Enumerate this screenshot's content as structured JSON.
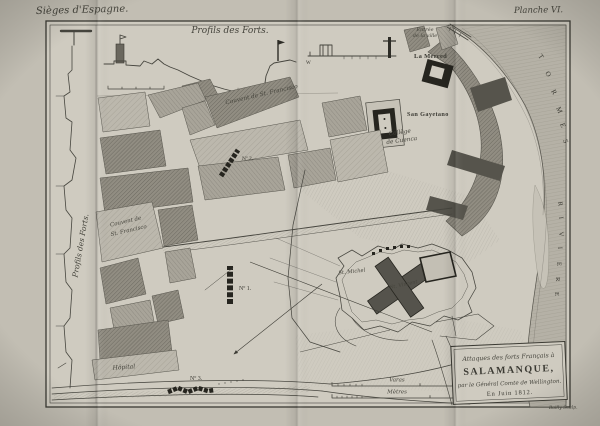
{
  "page": {
    "series_title": "Sièges d'Espagne.",
    "plate_label": "Planche VI.",
    "engraver_credit": "Bailly Sculp."
  },
  "profiles": {
    "title": "Profils des Forts.",
    "ref_letter_w": "W"
  },
  "map": {
    "labels": {
      "entree_line1": "Entrée",
      "entree_line2": "de la ville",
      "la_merced": "La Merced",
      "san_cayetano": "San Gayetano",
      "street_couvent": "Couvent de St. Francisco",
      "college_line1": "Collège",
      "college_line2": "de Cuenca",
      "couvent_line1": "Couvent de",
      "couvent_line2": "St. Francisco",
      "st_michel": "St. Michel",
      "st_vincent": "St. Vincent",
      "hopital": "Hôpital",
      "battery_1": "Nº 1.",
      "battery_2": "Nº 2.",
      "battery_3": "Nº 3."
    },
    "river": {
      "tormes": [
        "T",
        "O",
        "R",
        "M",
        "E",
        "S"
      ],
      "riviere": [
        "R",
        "I",
        "V",
        "I",
        "E",
        "R",
        "E"
      ]
    },
    "scales": {
      "varas": "Varas",
      "metres": "Mètres"
    }
  },
  "cartouche": {
    "line1": "Attaques des forts Français à",
    "line2": "SALAMANQUE,",
    "line3": "par le Général Comte de Wellington.",
    "line4": "En Juin 1812."
  },
  "colors": {
    "paper": "#cfcbc0",
    "margin_paper": "#c2beb3",
    "ink": "#3b3a33",
    "block_dark": "#918d82",
    "block_mid": "#a8a499",
    "block_light": "#bcb8ad",
    "water": "#b5b1a6",
    "battery_black": "#26251f"
  }
}
